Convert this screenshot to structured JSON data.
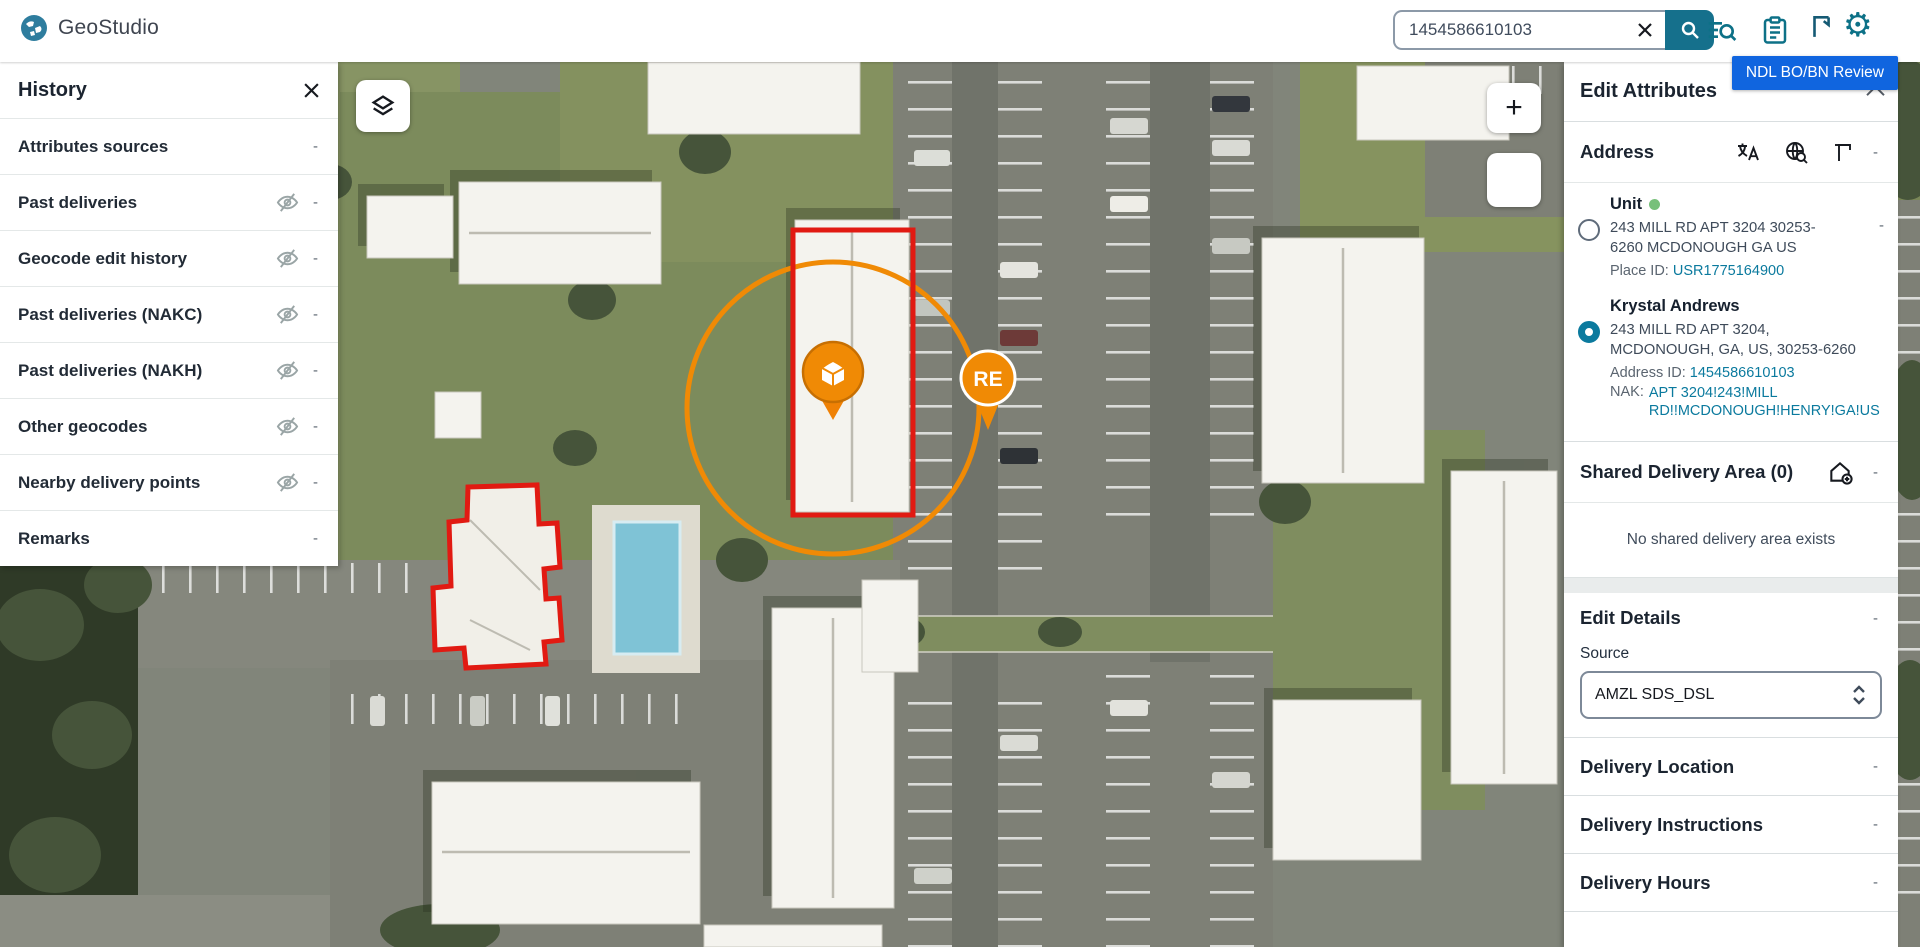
{
  "topbar": {
    "app_name": "GeoStudio",
    "search": {
      "value": "1454586610103"
    },
    "badge": "NDL BO/BN Review",
    "icon_names": [
      "search-list-icon",
      "clipboard-icon",
      "bookmark-icon",
      "gear-icon"
    ]
  },
  "history": {
    "title": "History",
    "items": [
      {
        "label": "Attributes sources",
        "visibility_toggle": false
      },
      {
        "label": "Past deliveries",
        "visibility_toggle": true
      },
      {
        "label": "Geocode edit history",
        "visibility_toggle": true
      },
      {
        "label": "Past deliveries (NAKC)",
        "visibility_toggle": true
      },
      {
        "label": "Past deliveries (NAKH)",
        "visibility_toggle": true
      },
      {
        "label": "Other geocodes",
        "visibility_toggle": true
      },
      {
        "label": "Nearby delivery points",
        "visibility_toggle": true
      },
      {
        "label": "Remarks",
        "visibility_toggle": false
      }
    ]
  },
  "map": {
    "zoom_in_label": "+",
    "re_label": "RE",
    "overlays": [
      "building-geofence-rectangle",
      "clubhouse-geofence-polygon",
      "delivery-radius-circle",
      "package-pin",
      "re-pin"
    ]
  },
  "panel": {
    "title": "Edit Attributes",
    "address": {
      "title": "Address",
      "icon_names": [
        "translate-icon",
        "globe-search-icon",
        "polygon-corner-icon"
      ],
      "options": [
        {
          "name": "Unit",
          "status_dot": "green",
          "selected": false,
          "address": "243 MILL RD APT 3204 30253-6260 MCDONOUGH GA US",
          "id_label": "Place ID:",
          "id_value": "USR1775164900"
        },
        {
          "name": "Krystal Andrews",
          "selected": true,
          "address": "243 MILL RD APT 3204, MCDONOUGH, GA, US, 30253-6260",
          "id_label": "Address ID:",
          "id_value": "1454586610103",
          "nak_label": "NAK:",
          "nak_value": "APT 3204!243!MILL RD!!MCDONOUGH!HENRY!GA!US"
        }
      ]
    },
    "shared": {
      "title": "Shared Delivery Area (0)",
      "icon_name": "house-add-icon",
      "empty": "No shared delivery area exists"
    },
    "details": {
      "title": "Edit Details",
      "source_label": "Source",
      "source_value": "AMZL SDS_DSL"
    },
    "sections": [
      "Delivery Location",
      "Delivery Instructions",
      "Delivery Hours"
    ]
  },
  "ui": {
    "dash": "-"
  },
  "icons": {
    "gear": "⚙"
  },
  "colors": {
    "accent_teal": "#0d7187",
    "link_teal": "#0b7a9e",
    "badge_blue": "#1065df",
    "marker_orange": "#f08a05",
    "boundary_red": "#e11a12",
    "status_green": "#77c07a"
  }
}
